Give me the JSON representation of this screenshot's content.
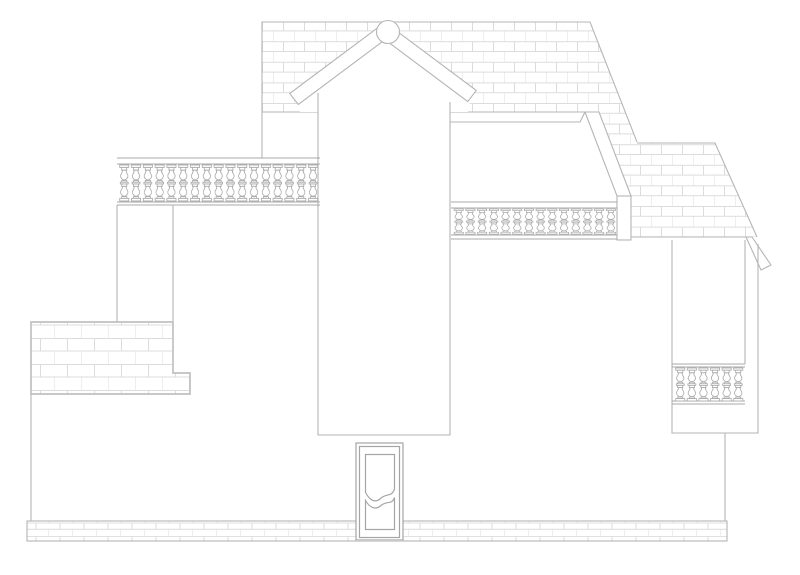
{
  "page": {
    "title": "House front elevation line drawing",
    "background": "#ffffff",
    "visible_text": "none"
  },
  "colors": {
    "outline": "#b5b5b5",
    "hatch": "#dcdcdc",
    "detail": "#a5a5a5",
    "heavy": "#c0c0c0",
    "rail": "#a8a8a8",
    "white": "#ffffff"
  },
  "components": {
    "upper_roof_band": "shingled upper wall/roof band",
    "gable": "gable with two bargeboards and round finial",
    "tower": "central projecting bay",
    "deck": "flat roof deck with balustrade",
    "side_roof": "right sloped shingled roof",
    "porch": "right porch pier with balustrade",
    "left_balustrade": "left terrace balustrade",
    "annex": "lower-left brick annex block",
    "plinth": "brick plinth strip at grade",
    "door": "two-panel entry door with wavy rails"
  },
  "balustrade_rows": [
    {
      "group": "left-balustrade-balusters",
      "x": 119.5,
      "y": 165,
      "count": 17,
      "pitch": 11.8,
      "scale": 1.09
    },
    {
      "group": "deck-balustrade-balusters",
      "x": 454.0,
      "y": 209,
      "count": 14,
      "pitch": 11.7,
      "scale": 0.76
    },
    {
      "group": "porch-balustrade-balusters",
      "x": 675.5,
      "y": 368,
      "count": 6,
      "pitch": 11.6,
      "scale": 1.0
    }
  ]
}
